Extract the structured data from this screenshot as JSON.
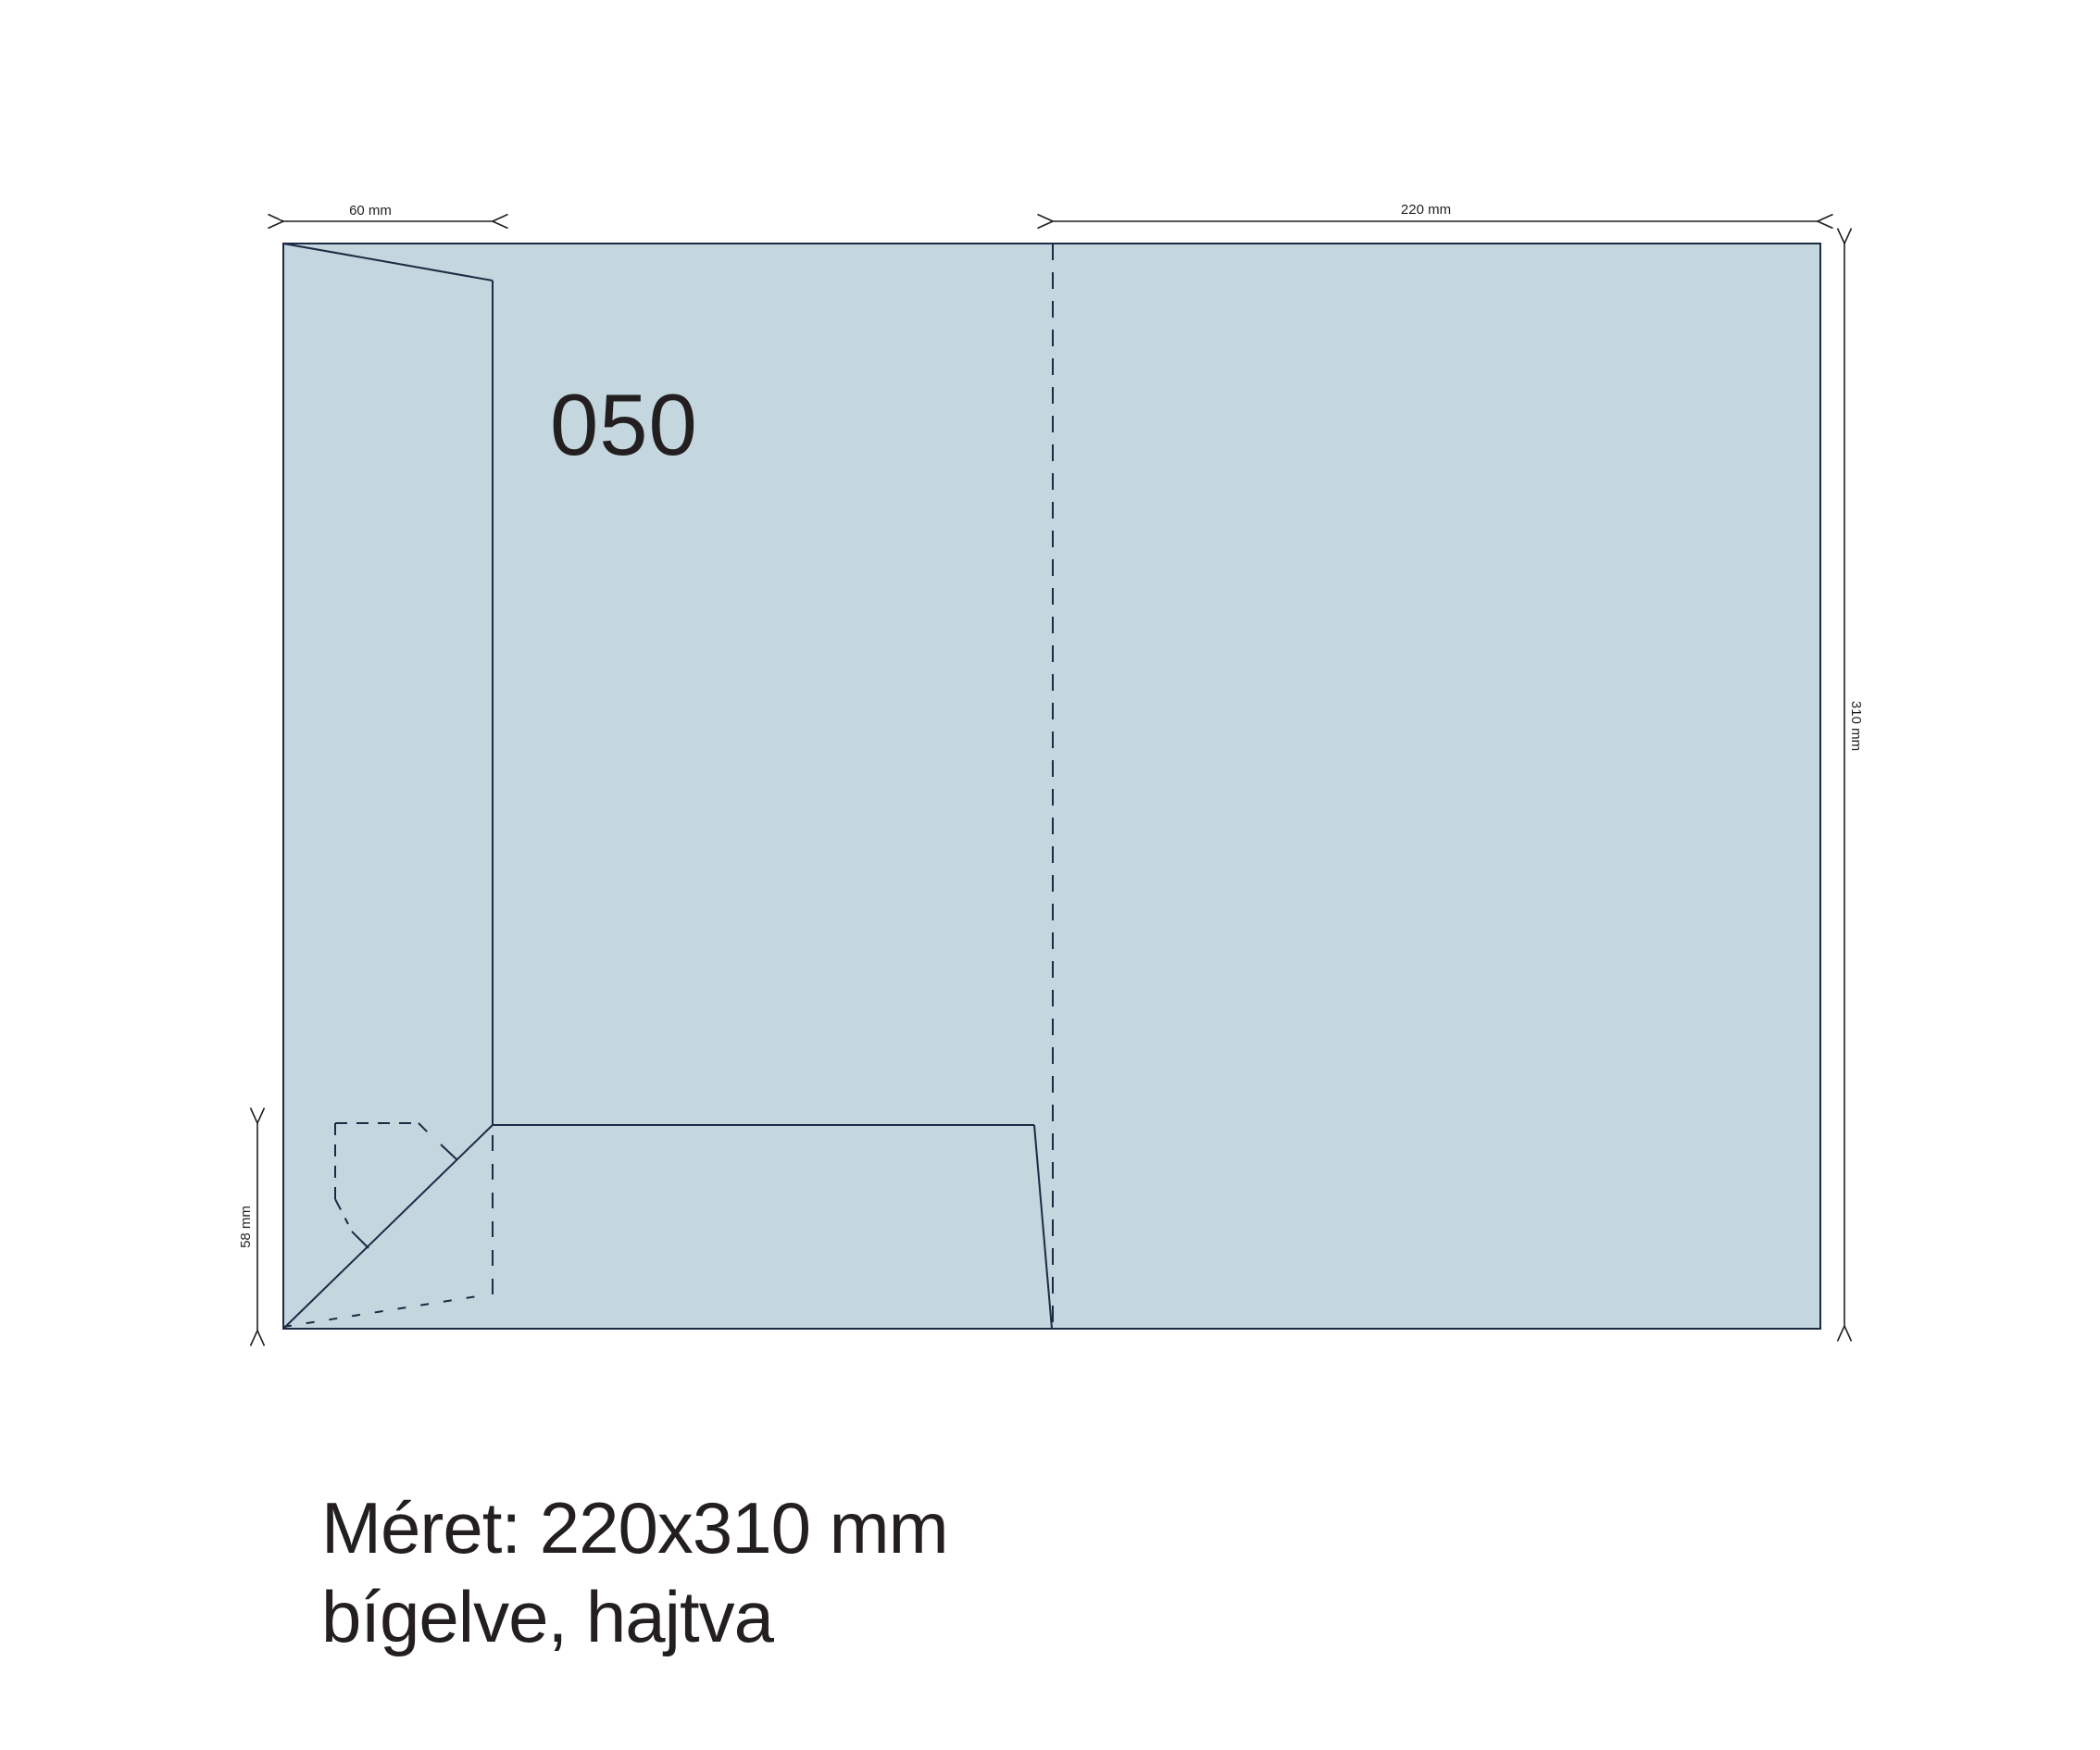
{
  "sheet": {
    "product_code": "050"
  },
  "dimensions": {
    "flap_width": "60 mm",
    "panel_width": "220 mm",
    "sheet_height": "310 mm",
    "pocket_height": "58 mm"
  },
  "caption": {
    "line1": "Méret: 220x310 mm",
    "line2": "bígelve, hajtva"
  },
  "colors": {
    "background": "#ffffff",
    "sheet-fill": "#c4d6de",
    "cut-line": "#1d2a44",
    "dim-line": "#1f1f1f",
    "text": "#231f20"
  }
}
